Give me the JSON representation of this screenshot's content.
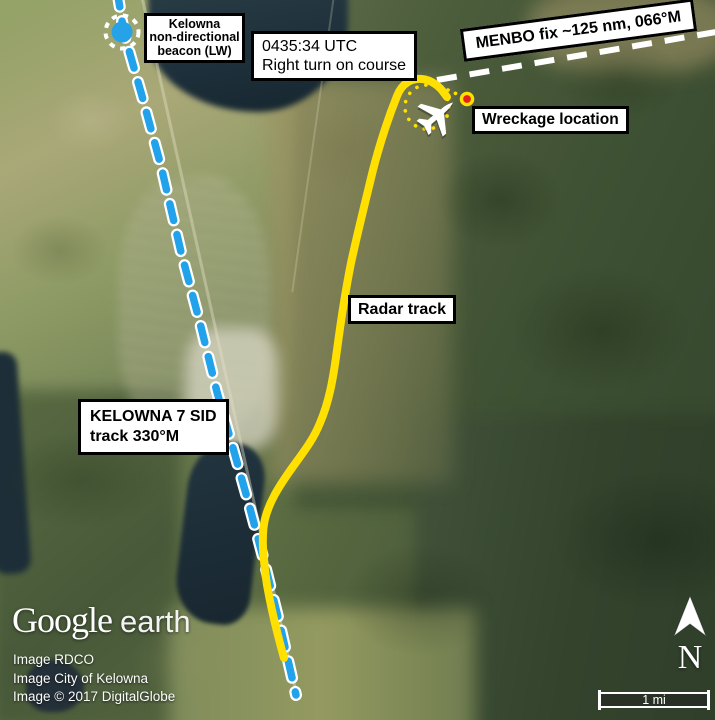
{
  "figure": {
    "type": "annotated satellite map",
    "subject": "Kelowna departure radar track"
  },
  "colors": {
    "radar_track": "#ffe000",
    "sid_dash": "#22a2ea",
    "menbo_dash": "#ffffff",
    "wreckage_red": "#e3201b",
    "beacon_blue": "#26a3e8"
  },
  "labels": {
    "ndb": {
      "line1": "Kelowna",
      "line2": "non-directional",
      "line3": "beacon (LW)"
    },
    "turn": {
      "line1": "0435:34 UTC",
      "line2": "Right turn on course"
    },
    "menbo": "MENBO fix ~125 nm, 066°M",
    "wreckage": "Wreckage location",
    "radar_track": "Radar track",
    "sid": {
      "line1": "KELOWNA 7 SID",
      "line2": "track 330°M"
    }
  },
  "branding": {
    "logo_primary": "Google",
    "logo_secondary": "earth"
  },
  "attribution": [
    "Image RDCO",
    "Image City of Kelowna",
    "Image © 2017 DigitalGlobe"
  ],
  "compass": {
    "north": "N"
  },
  "scale_bar": {
    "label": "1 mi"
  }
}
